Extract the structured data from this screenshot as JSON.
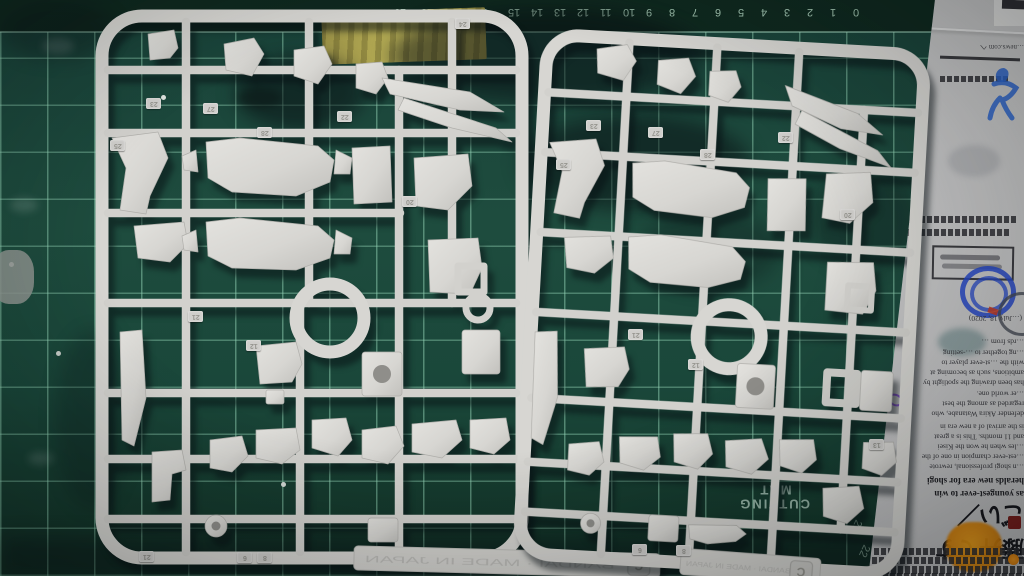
{
  "scene": {
    "description": "Two light-gray plastic model kit runners (sprue C x2) laid on a green cutting mat, with a folded newspaper at the right edge"
  },
  "colors": {
    "mat_base": "#1e4c3e",
    "mat_grid": "#96d6b8",
    "mat_border": "#0f291f",
    "plastic": "#d7d6d2",
    "plastic_shadow": "#b0afab",
    "newspaper": "#b4b4b7",
    "tape": "#a89f4c",
    "ink_blue": "#2648c8",
    "stain_orange": "#f0950e"
  },
  "mat": {
    "label_line1": "CUTTING",
    "label_line2": "MAT",
    "top_ruler": [
      "0",
      "1",
      "2",
      "3",
      "4",
      "5",
      "6",
      "7",
      "8",
      "9",
      "10",
      "11",
      "12",
      "13",
      "14",
      "15",
      "16",
      "17",
      "18",
      "19"
    ],
    "right_ruler": [
      {
        "n": "20",
        "x": 841,
        "y": 494
      },
      {
        "n": "21",
        "x": 850,
        "y": 520
      },
      {
        "n": "22",
        "x": 858,
        "y": 545
      },
      {
        "n": "23",
        "x": 866,
        "y": 568
      }
    ]
  },
  "runners": {
    "embossed_text": "BANDAI · MADE IN JAPAN",
    "left": {
      "letter": "C",
      "tags": [
        {
          "n": "23",
          "x": 146,
          "y": 98
        },
        {
          "n": "27",
          "x": 203,
          "y": 103
        },
        {
          "n": "28",
          "x": 257,
          "y": 127
        },
        {
          "n": "25",
          "x": 110,
          "y": 140
        },
        {
          "n": "22",
          "x": 337,
          "y": 111
        },
        {
          "n": "24",
          "x": 455,
          "y": 18
        },
        {
          "n": "21",
          "x": 188,
          "y": 311
        },
        {
          "n": "12",
          "x": 246,
          "y": 340
        },
        {
          "n": "20",
          "x": 402,
          "y": 196
        },
        {
          "n": "21",
          "x": 139,
          "y": 551
        },
        {
          "n": "6",
          "x": 237,
          "y": 552
        },
        {
          "n": "8",
          "x": 257,
          "y": 552
        }
      ]
    },
    "right": {
      "letter": "C",
      "tags": [
        {
          "n": "23",
          "x": 586,
          "y": 120
        },
        {
          "n": "27",
          "x": 648,
          "y": 127
        },
        {
          "n": "28",
          "x": 700,
          "y": 149
        },
        {
          "n": "25",
          "x": 556,
          "y": 159
        },
        {
          "n": "22",
          "x": 778,
          "y": 132
        },
        {
          "n": "21",
          "x": 628,
          "y": 329
        },
        {
          "n": "12",
          "x": 688,
          "y": 359
        },
        {
          "n": "20",
          "x": 840,
          "y": 209
        },
        {
          "n": "13",
          "x": 869,
          "y": 439
        },
        {
          "n": "6",
          "x": 632,
          "y": 544
        },
        {
          "n": "8",
          "x": 676,
          "y": 545
        }
      ]
    }
  },
  "newspaper": {
    "url_line": "…news.com へ",
    "date_line": "(…July 18, 2020)",
    "calligraphy_headline": "藤井てすごい／",
    "article_lines": [
      {
        "text": "…rds from …",
        "y": 338,
        "bold": false
      },
      {
        "text": "…ng together to …-setting",
        "y": 349,
        "bold": false
      },
      {
        "text": "with the …st-ever player to",
        "y": 359,
        "bold": false
      },
      {
        "text": "ambitions, such as becoming at",
        "y": 369,
        "bold": false
      },
      {
        "text": "has been drawing the spotlight by",
        "y": 379,
        "bold": false
      },
      {
        "text": "…er world one.",
        "y": 390,
        "bold": false
      },
      {
        "text": "regarded as among the best",
        "y": 400,
        "bold": false
      },
      {
        "text": "defender Akira Watanabe, who",
        "y": 410,
        "bold": false
      },
      {
        "text": "is the arrival of a new era in",
        "y": 423,
        "bold": false
      },
      {
        "text": "and 11 months. This is a great",
        "y": 433,
        "bold": false
      },
      {
        "text": "…les when he won the Kisei",
        "y": 443,
        "bold": false
      },
      {
        "text": "…est-ever champion in one of the",
        "y": 453,
        "bold": false
      },
      {
        "text": "…n shogi professional, rewrote",
        "y": 463,
        "bold": false
      },
      {
        "text": "heralds new era for shogi",
        "y": 476,
        "bold": true
      },
      {
        "text": "as youngest-ever to win",
        "y": 489,
        "bold": true
      }
    ]
  }
}
